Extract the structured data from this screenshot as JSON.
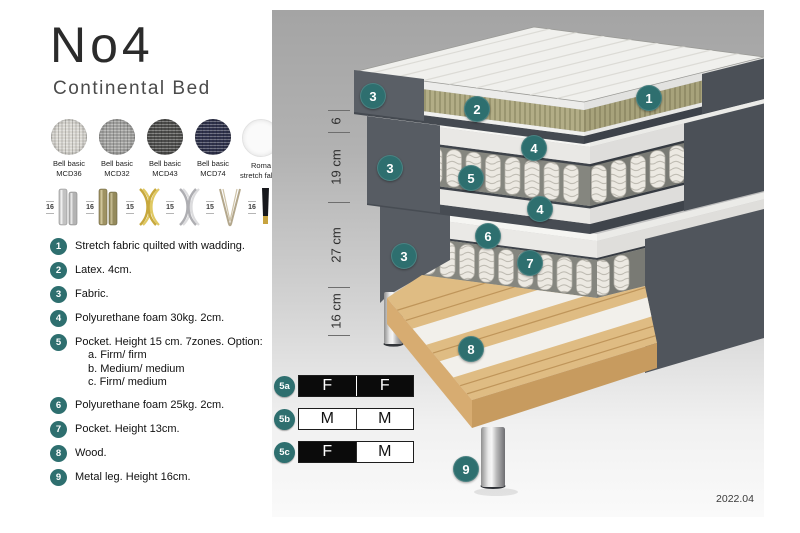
{
  "header": {
    "title": "No4",
    "subtitle": "Continental Bed"
  },
  "fabrics": [
    {
      "line1": "Bell basic",
      "line2": "MCD36",
      "color": "#d8d6d0",
      "texture": "weave"
    },
    {
      "line1": "Bell basic",
      "line2": "MCD32",
      "color": "#a2a2a0",
      "texture": "weave"
    },
    {
      "line1": "Bell basic",
      "line2": "MCD43",
      "color": "#4e4e4c",
      "texture": "weave"
    },
    {
      "line1": "Bell basic",
      "line2": "MCD74",
      "color": "#30334d",
      "texture": "weave"
    },
    {
      "line1": "Roma",
      "line2": "stretch fabric",
      "color": "#fafafa",
      "texture": "plain"
    }
  ],
  "leg_options": [
    {
      "height": "16",
      "style": "cylinder-chrome"
    },
    {
      "height": "16",
      "style": "cylinder-brass"
    },
    {
      "height": "15",
      "style": "cross-gold"
    },
    {
      "height": "15",
      "style": "cross-silver"
    },
    {
      "height": "15",
      "style": "hairpin"
    },
    {
      "height": "16",
      "style": "tapered-black"
    }
  ],
  "features": [
    {
      "num": "1",
      "text": "Stretch fabric quilted with wadding."
    },
    {
      "num": "2",
      "text": "Latex. 4cm."
    },
    {
      "num": "3",
      "text": "Fabric."
    },
    {
      "num": "4",
      "text": "Polyurethane foam 30kg. 2cm."
    },
    {
      "num": "5",
      "text": "Pocket. Height 15 cm. 7zones. Option:",
      "options": [
        "a. Firm/ firm",
        "b. Medium/ medium",
        "c. Firm/ medium"
      ]
    },
    {
      "num": "6",
      "text": "Polyurethane foam 25kg. 2cm."
    },
    {
      "num": "7",
      "text": "Pocket. Height 13cm."
    },
    {
      "num": "8",
      "text": "Wood."
    },
    {
      "num": "9",
      "text": "Metal leg. Height 16cm."
    }
  ],
  "diagram": {
    "callouts": [
      {
        "label": "1",
        "x": 377,
        "y": 88
      },
      {
        "label": "2",
        "x": 205,
        "y": 99
      },
      {
        "label": "3",
        "x": 101,
        "y": 86
      },
      {
        "label": "4",
        "x": 262,
        "y": 138
      },
      {
        "label": "5",
        "x": 199,
        "y": 168
      },
      {
        "label": "4",
        "x": 268,
        "y": 199
      },
      {
        "label": "3",
        "x": 118,
        "y": 158
      },
      {
        "label": "6",
        "x": 216,
        "y": 226
      },
      {
        "label": "7",
        "x": 258,
        "y": 253
      },
      {
        "label": "3",
        "x": 132,
        "y": 246
      },
      {
        "label": "8",
        "x": 199,
        "y": 339
      },
      {
        "label": "9",
        "x": 194,
        "y": 459
      }
    ],
    "dimensions": [
      {
        "label": "6",
        "from": 100,
        "to": 122
      },
      {
        "label": "19 cm",
        "from": 122,
        "to": 192
      },
      {
        "label": "27 cm",
        "from": 192,
        "to": 277
      },
      {
        "label": "16 cm",
        "from": 277,
        "to": 325
      }
    ],
    "firmness": [
      {
        "label": "5a",
        "cells": [
          {
            "text": "F",
            "variant": "dark"
          },
          {
            "text": "F",
            "variant": "dark"
          }
        ]
      },
      {
        "label": "5b",
        "cells": [
          {
            "text": "M",
            "variant": "light"
          },
          {
            "text": "M",
            "variant": "light"
          }
        ]
      },
      {
        "label": "5c",
        "cells": [
          {
            "text": "F",
            "variant": "dark"
          },
          {
            "text": "M",
            "variant": "light"
          }
        ]
      }
    ],
    "version": "2022.04"
  },
  "colors": {
    "accent": "#2e6f6f"
  }
}
